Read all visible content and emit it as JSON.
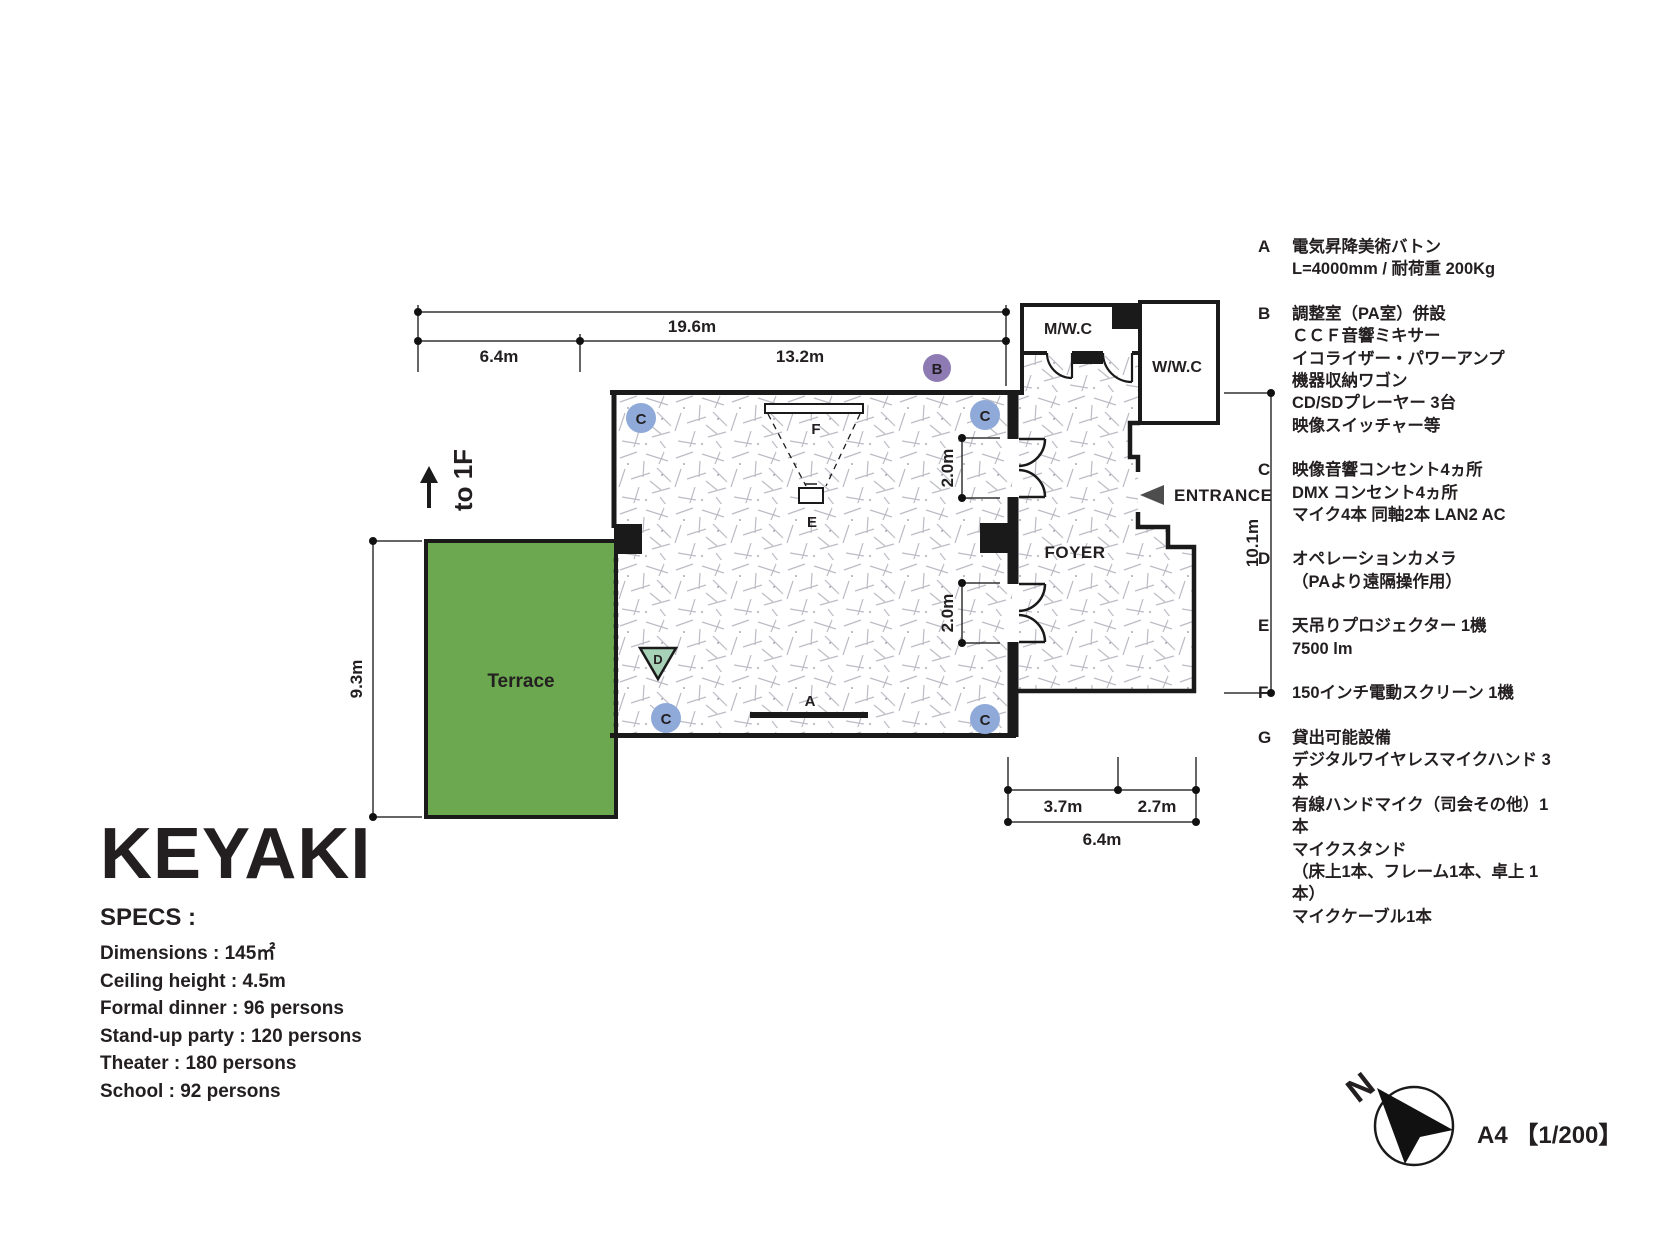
{
  "title": "KEYAKI",
  "specs": {
    "heading": "SPECS :",
    "items": [
      "Dimensions : 145㎡",
      "Ceiling height : 4.5m",
      "Formal dinner : 96 persons",
      "Stand-up party : 120 persons",
      "Theater : 180 persons",
      "School : 92 persons"
    ]
  },
  "legend": {
    "items": [
      {
        "key": "A",
        "lines": [
          "電気昇降美術バトン",
          "L=4000mm / 耐荷重 200Kg"
        ]
      },
      {
        "key": "B",
        "lines": [
          "調整室（PA室）併設",
          "ＣＣＦ音響ミキサー",
          "イコライザー・パワーアンプ",
          "機器収納ワゴン",
          "CD/SDプレーヤー 3台",
          "映像スイッチャー等"
        ]
      },
      {
        "key": "C",
        "lines": [
          "映像音響コンセント4ヵ所",
          "DMX コンセント4ヵ所",
          "マイク4本 同軸2本 LAN2 AC"
        ]
      },
      {
        "key": "D",
        "lines": [
          "オペレーションカメラ",
          "（PAより遠隔操作用）"
        ]
      },
      {
        "key": "E",
        "lines": [
          "天吊りプロジェクター 1機",
          "7500 lm"
        ]
      },
      {
        "key": "F",
        "lines": [
          "150インチ電動スクリーン 1機"
        ]
      },
      {
        "key": "G",
        "lines": [
          "貸出可能設備",
          "デジタルワイヤレスマイクハンド 3本",
          "有線ハンドマイク（司会その他）1本",
          "マイクスタンド",
          "（床上1本、フレーム1本、卓上 1本）",
          "マイクケーブル1本"
        ]
      }
    ]
  },
  "plan": {
    "labels": {
      "terrace": "Terrace",
      "foyer": "FOYER",
      "mwc": "M/W.C",
      "wwc": "W/W.C",
      "entrance": "ENTRANCE",
      "to_1f": "to 1F"
    },
    "markers": {
      "a": "A",
      "b": "B",
      "c": "C",
      "d": "D",
      "e": "E",
      "f": "F"
    },
    "dimensions": {
      "top_total": "19.6m",
      "top_left": "6.4m",
      "top_right": "13.2m",
      "terrace_height": "9.3m",
      "right_height": "10.1m",
      "door_top": "2.0m",
      "door_bottom": "2.0m",
      "bottom_left": "3.7m",
      "bottom_right": "2.7m",
      "bottom_total": "6.4m"
    }
  },
  "footer": {
    "north": "N",
    "scale": "A4 【1/200】"
  },
  "colors": {
    "terrace_green": "#6BA84F",
    "marker_c_blue": "#8FA9D9",
    "marker_b_purple": "#8E7BB4",
    "marker_d_green": "#A8D2B8",
    "wall_black": "#1a1a1a",
    "entrance_gray": "#4d4d4d"
  }
}
